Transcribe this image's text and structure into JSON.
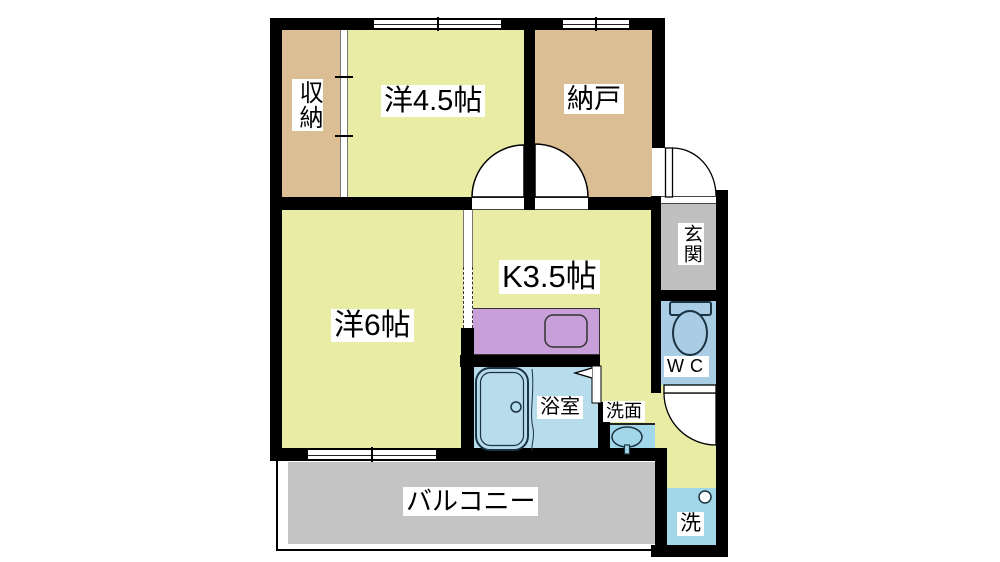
{
  "floorplan": {
    "title": "apartment-floor-plan",
    "rooms": {
      "storage_top": {
        "label": "収納"
      },
      "western_45": {
        "label": "洋4.5帖"
      },
      "nando": {
        "label": "納戸"
      },
      "western_6": {
        "label": "洋6帖"
      },
      "kitchen": {
        "label": "K3.5帖"
      },
      "genkan": {
        "label": "玄関"
      },
      "wc": {
        "label": "WC"
      },
      "bathroom": {
        "label": "浴室"
      },
      "washroom": {
        "label": "洗面"
      },
      "laundry": {
        "label": "洗"
      },
      "balcony": {
        "label": "バルコニー"
      }
    },
    "fixtures": [
      "toilet-icon",
      "bathtub-icon",
      "washbasin-icon",
      "kitchen-sink-icon",
      "washer-tap-icon",
      "door-swing-arc",
      "folding-door-icon",
      "sliding-door",
      "window"
    ],
    "colors": {
      "wall": "#000000",
      "tan": "#dcbe94",
      "green": "#e9eca4",
      "gray": "#c0c0c0",
      "balcony": "#c4c4c4",
      "wc": "#a8cde4",
      "bath": "#b7dcec",
      "cyan": "#a2d7e9",
      "purple": "#c99fd9",
      "line": "#1b3342",
      "frame": "#777777"
    }
  }
}
